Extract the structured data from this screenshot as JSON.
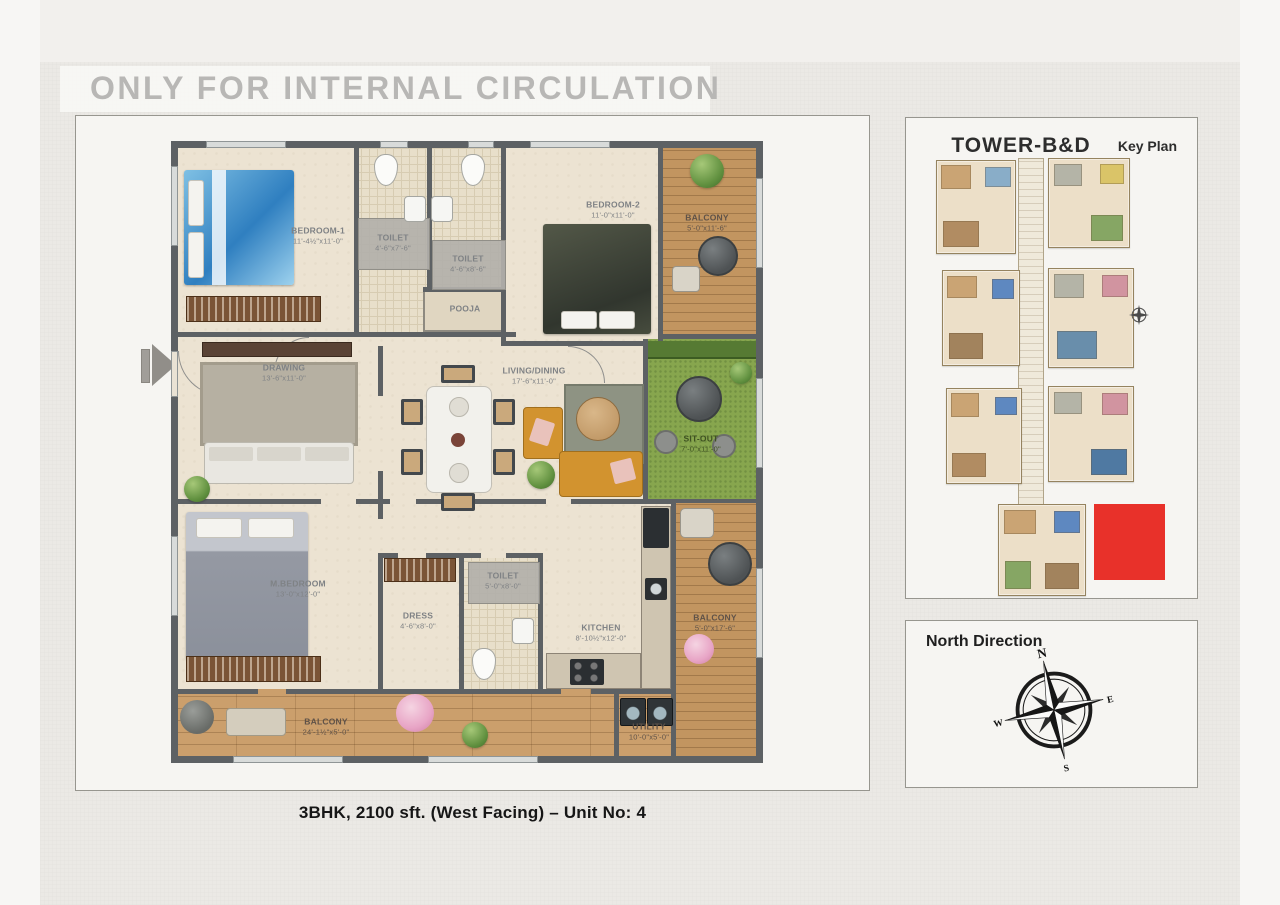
{
  "watermark": "ONLY FOR INTERNAL CIRCULATION",
  "caption": "3BHK, 2100 sft. (West Facing) – Unit No: 4",
  "plan": {
    "rooms": {
      "bedroom1": {
        "name": "BEDROOM-1",
        "dims": "11'-4½\"x11'-0\""
      },
      "toilet1": {
        "name": "TOILET",
        "dims": "4'-6\"x7'-6\""
      },
      "toilet2": {
        "name": "TOILET",
        "dims": "4'-6\"x8'-6\""
      },
      "pooja": {
        "name": "POOJA",
        "dims": ""
      },
      "bedroom2": {
        "name": "BEDROOM-2",
        "dims": "11'-0\"x11'-0\""
      },
      "balcony_top": {
        "name": "BALCONY",
        "dims": "5'-0\"x11'-6\""
      },
      "drawing": {
        "name": "DRAWING",
        "dims": "13'-6\"x11'-0\""
      },
      "living": {
        "name": "LIVING/DINING",
        "dims": "17'-6\"x11'-0\""
      },
      "sitout": {
        "name": "SIT-OUT",
        "dims": "7'-0\"x11'-0\""
      },
      "mbedroom": {
        "name": "M.BEDROOM",
        "dims": "13'-0\"x12'-0\""
      },
      "dress": {
        "name": "DRESS",
        "dims": "4'-6\"x8'-0\""
      },
      "toilet3": {
        "name": "TOILET",
        "dims": "5'-0\"x8'-0\""
      },
      "kitchen": {
        "name": "KITCHEN",
        "dims": "8'-10½\"x12'-0\""
      },
      "balcony_right": {
        "name": "BALCONY",
        "dims": "5'-0\"x17'-6\""
      },
      "balcony_bottom": {
        "name": "BALCONY",
        "dims": "24'-1½\"x5'-0\""
      },
      "utility": {
        "name": "UTILITY",
        "dims": "10'-0\"x5'-0\""
      }
    }
  },
  "key_plan": {
    "title": "TOWER-B&D",
    "subtitle": "Key Plan"
  },
  "north": {
    "title": "North Direction",
    "n": "N",
    "e": "E",
    "s": "S",
    "w": "W"
  },
  "colors": {
    "highlight_red": "#e8312a",
    "wall": "#5d6164",
    "floor": "#ece3d2",
    "wood": "#c29560",
    "grass": "#87a64e",
    "watermark_gray": "#b8b7b5"
  }
}
